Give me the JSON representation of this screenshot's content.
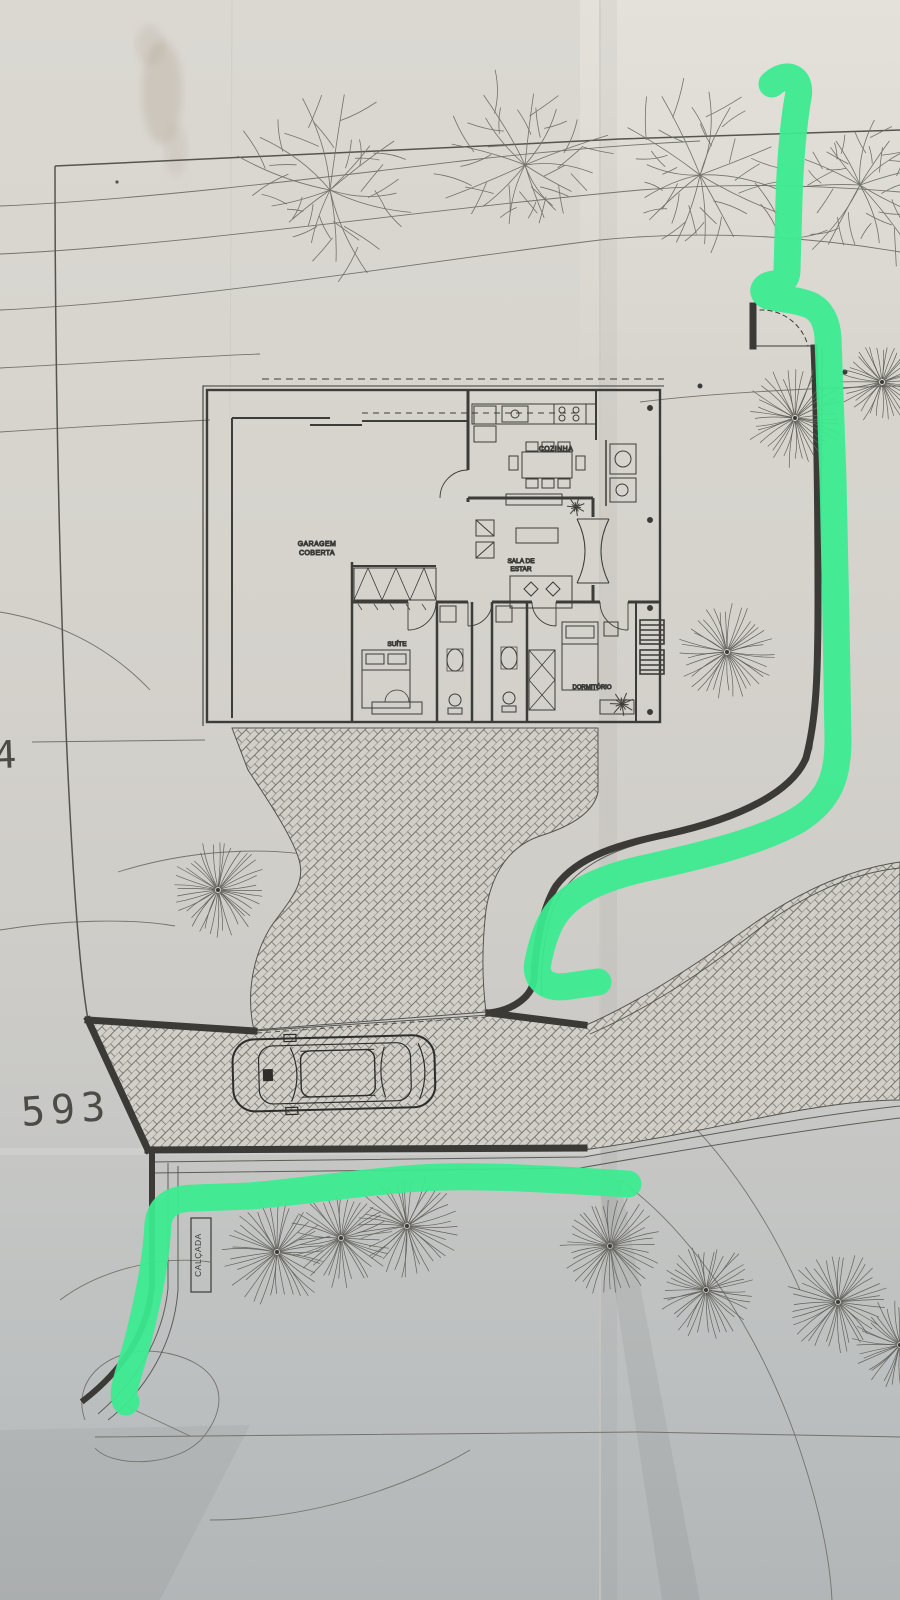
{
  "document": {
    "kind": "photographed architectural site plan with green marker route annotations"
  },
  "labels": {
    "garagem_line1": "GARAGEM",
    "garagem_line2": "COBERTA",
    "cozinha": "COZINHA",
    "sala_line1": "SALA DE",
    "sala_line2": "ESTAR",
    "suite": "SUÍTE",
    "dormitorio": "DORMITÓRIO",
    "elevation_593": "593",
    "elevation_4": "4",
    "curb_vertical": "CALÇADA"
  },
  "colors": {
    "marker_green": "#3ceb91",
    "paper": "#d7d4ce",
    "street_gray": "#bcc0c1",
    "ink": "#4a4945",
    "wall_dark": "#3b3a36"
  },
  "icons": [
    {
      "name": "fan-tree"
    },
    {
      "name": "branch-tree"
    },
    {
      "name": "plant"
    },
    {
      "name": "car-top-view"
    },
    {
      "name": "green-marker-stroke"
    }
  ]
}
